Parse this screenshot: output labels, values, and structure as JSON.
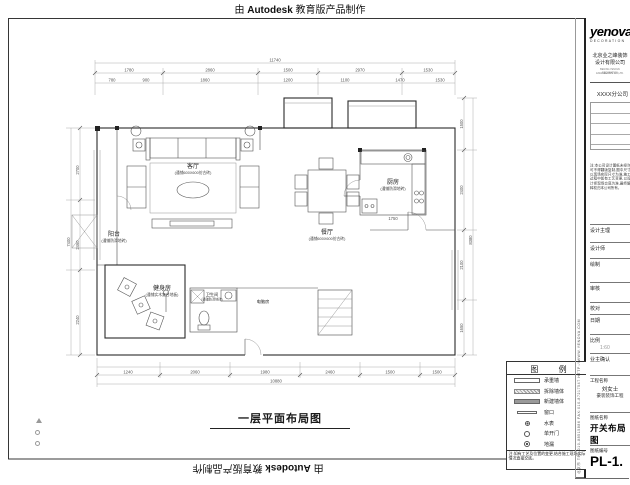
{
  "stamps": {
    "pre": "由 ",
    "brand": "Autodesk",
    "post": " 教育版产品制作"
  },
  "plan": {
    "title": "一层平面布局图",
    "rooms": {
      "living": {
        "name": "客厅",
        "note": "(通铺600X600仿古砖)"
      },
      "dining": {
        "name": "餐厅",
        "note": "(通铺600X600仿古砖)"
      },
      "kitchen": {
        "name": "厨房",
        "note": "(通铺防滑地砖)"
      },
      "balcony": {
        "name": "阳台",
        "note": "(通铺防滑地砖)"
      },
      "gym": {
        "name": "健身房",
        "note": "(通铺实木复合地板)"
      },
      "bath": {
        "name": "卫生间",
        "note": "(通铺防滑地砖)"
      },
      "study": {
        "name": "电脑房"
      }
    },
    "dims": {
      "top_total": "11740",
      "top_segs": [
        "1780",
        "2860",
        "1500",
        "2970",
        "1530"
      ],
      "top_fine": [
        "780",
        "900",
        "1860",
        "1200",
        "1100",
        "1470",
        "1530"
      ],
      "right_segs": [
        "1500",
        "2400",
        "2100",
        "1650"
      ],
      "right_total": "8380",
      "left_segs": [
        "2700",
        "2460",
        "2240"
      ],
      "left_total": "7400",
      "bottom_segs": [
        "1240",
        "2060",
        "1980",
        "2460",
        "1500",
        "1500"
      ],
      "bottom_total": "10880",
      "kitchen_dim": "1750"
    }
  },
  "legend": {
    "title": "图 例",
    "items": [
      {
        "symbol": "original-wall-swatch",
        "label": "承重墙"
      },
      {
        "symbol": "demolish-wall-swatch",
        "label": "拆除墙体"
      },
      {
        "symbol": "new-wall-swatch",
        "label": "新建墙体"
      },
      {
        "symbol": "window-swatch",
        "label": "窗口"
      },
      {
        "symbol": "water-meter-symbol",
        "label": "水表"
      },
      {
        "symbol": "single-door-symbol",
        "label": "单开门"
      },
      {
        "symbol": "floor-drain-symbol",
        "label": "地漏"
      }
    ],
    "note": "注:如有工艺及位置的变更,结合施工现场实际情况直接交底。"
  },
  "titleblock": {
    "logo": "yenova",
    "logo_sub": "DECORATION",
    "company_cn1": "北京业之峰装饰",
    "company_cn2": "设计有限公司",
    "company_en1": "BEIJING YENOVA DECORATION",
    "company_en2": "ENGINEERING CO.,LTD.",
    "branch": "XXXX分公司",
    "disclaimer": "注:本公司设计图纸未经许可不得翻版复制,图中尺寸以现场实际尺寸为准,施工过程中如有工艺变更,以设计师现场交底为准,最终解释权归本公司所有。",
    "fields": [
      {
        "label": "设计主理",
        "value": ""
      },
      {
        "label": "设计师",
        "value": ""
      },
      {
        "label": "绘制",
        "value": ""
      },
      {
        "label": "审核",
        "value": ""
      },
      {
        "label": "校对",
        "value": ""
      },
      {
        "label": "日期",
        "value": ""
      },
      {
        "label": "比例",
        "value": "1:60"
      },
      {
        "label": "业主确认",
        "value": ""
      }
    ],
    "project": {
      "label": "工程名称",
      "line1": "刘女士",
      "line2": "豪装装饰工程"
    },
    "drawing": {
      "label": "图纸名称",
      "value": "开关布局图"
    },
    "number": {
      "label": "图纸编号",
      "value": "PL-1."
    },
    "contact": "北京市 TEL:010-88515886 FAX:010-87217547 HTTP://WWW.YENOVA.COM"
  },
  "marks": [
    "triangle",
    "circle",
    "circle"
  ]
}
